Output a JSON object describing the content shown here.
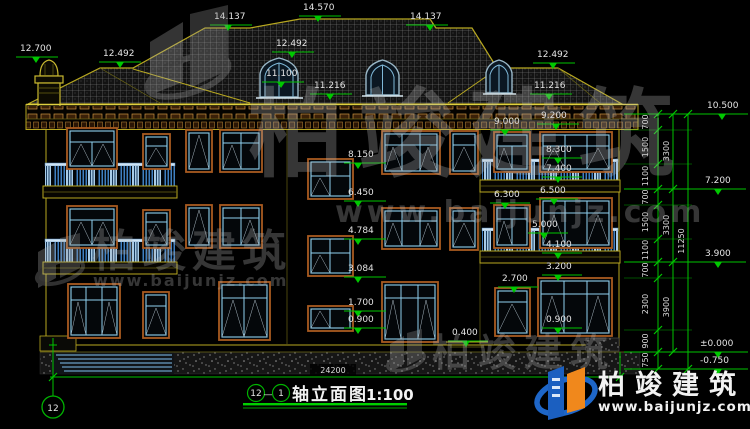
{
  "drawing": {
    "axis_from": "12",
    "axis_sep": "—",
    "axis_to": "1",
    "title": "轴立面图",
    "scale_text": "1:100",
    "axis_bubble": "12"
  },
  "levels": {
    "l12700": "12.700",
    "l12492": "12.492",
    "l14137": "14.137",
    "l14570": "14.570",
    "l11100": "11.100",
    "l11216": "11.216",
    "l10500": "10.500",
    "l9000": "9.000",
    "l9200": "9.200",
    "l8300": "8.300",
    "l8150": "8.150",
    "l7400": "7.400",
    "l7200": "7.200",
    "l6500": "6.500",
    "l6450": "6.450",
    "l6300": "6.300",
    "l5000": "5.000",
    "l4784": "4.784",
    "l4100": "4.100",
    "l3900": "3.900",
    "l3200": "3.200",
    "l3084": "3.084",
    "l2700": "2.700",
    "l1700": "1.700",
    "l0900": "0.900",
    "l0400": "0.400",
    "l0000": "±0.000",
    "lm0750": "-0.750"
  },
  "dims": {
    "segments": [
      "700",
      "1500",
      "1100",
      "700",
      "1500",
      "1100",
      "700",
      "2300",
      "900",
      "750"
    ],
    "totals": [
      "3300",
      "3300",
      "3900"
    ],
    "overall": "11250",
    "width": "24200"
  },
  "watermark": {
    "brand": "柏竣建筑",
    "url": "www.baijunjz.com"
  },
  "logo": {
    "brand": "柏竣建筑",
    "url": "www.baijunjz.com"
  },
  "colors": {
    "dim_green": "#00c400",
    "line_yellow": "#b8a820",
    "frame_brown": "#a85a20",
    "window_blue": "#8fd0f0",
    "logo_blue": "#1b5fc0",
    "logo_orange": "#f0881c"
  }
}
